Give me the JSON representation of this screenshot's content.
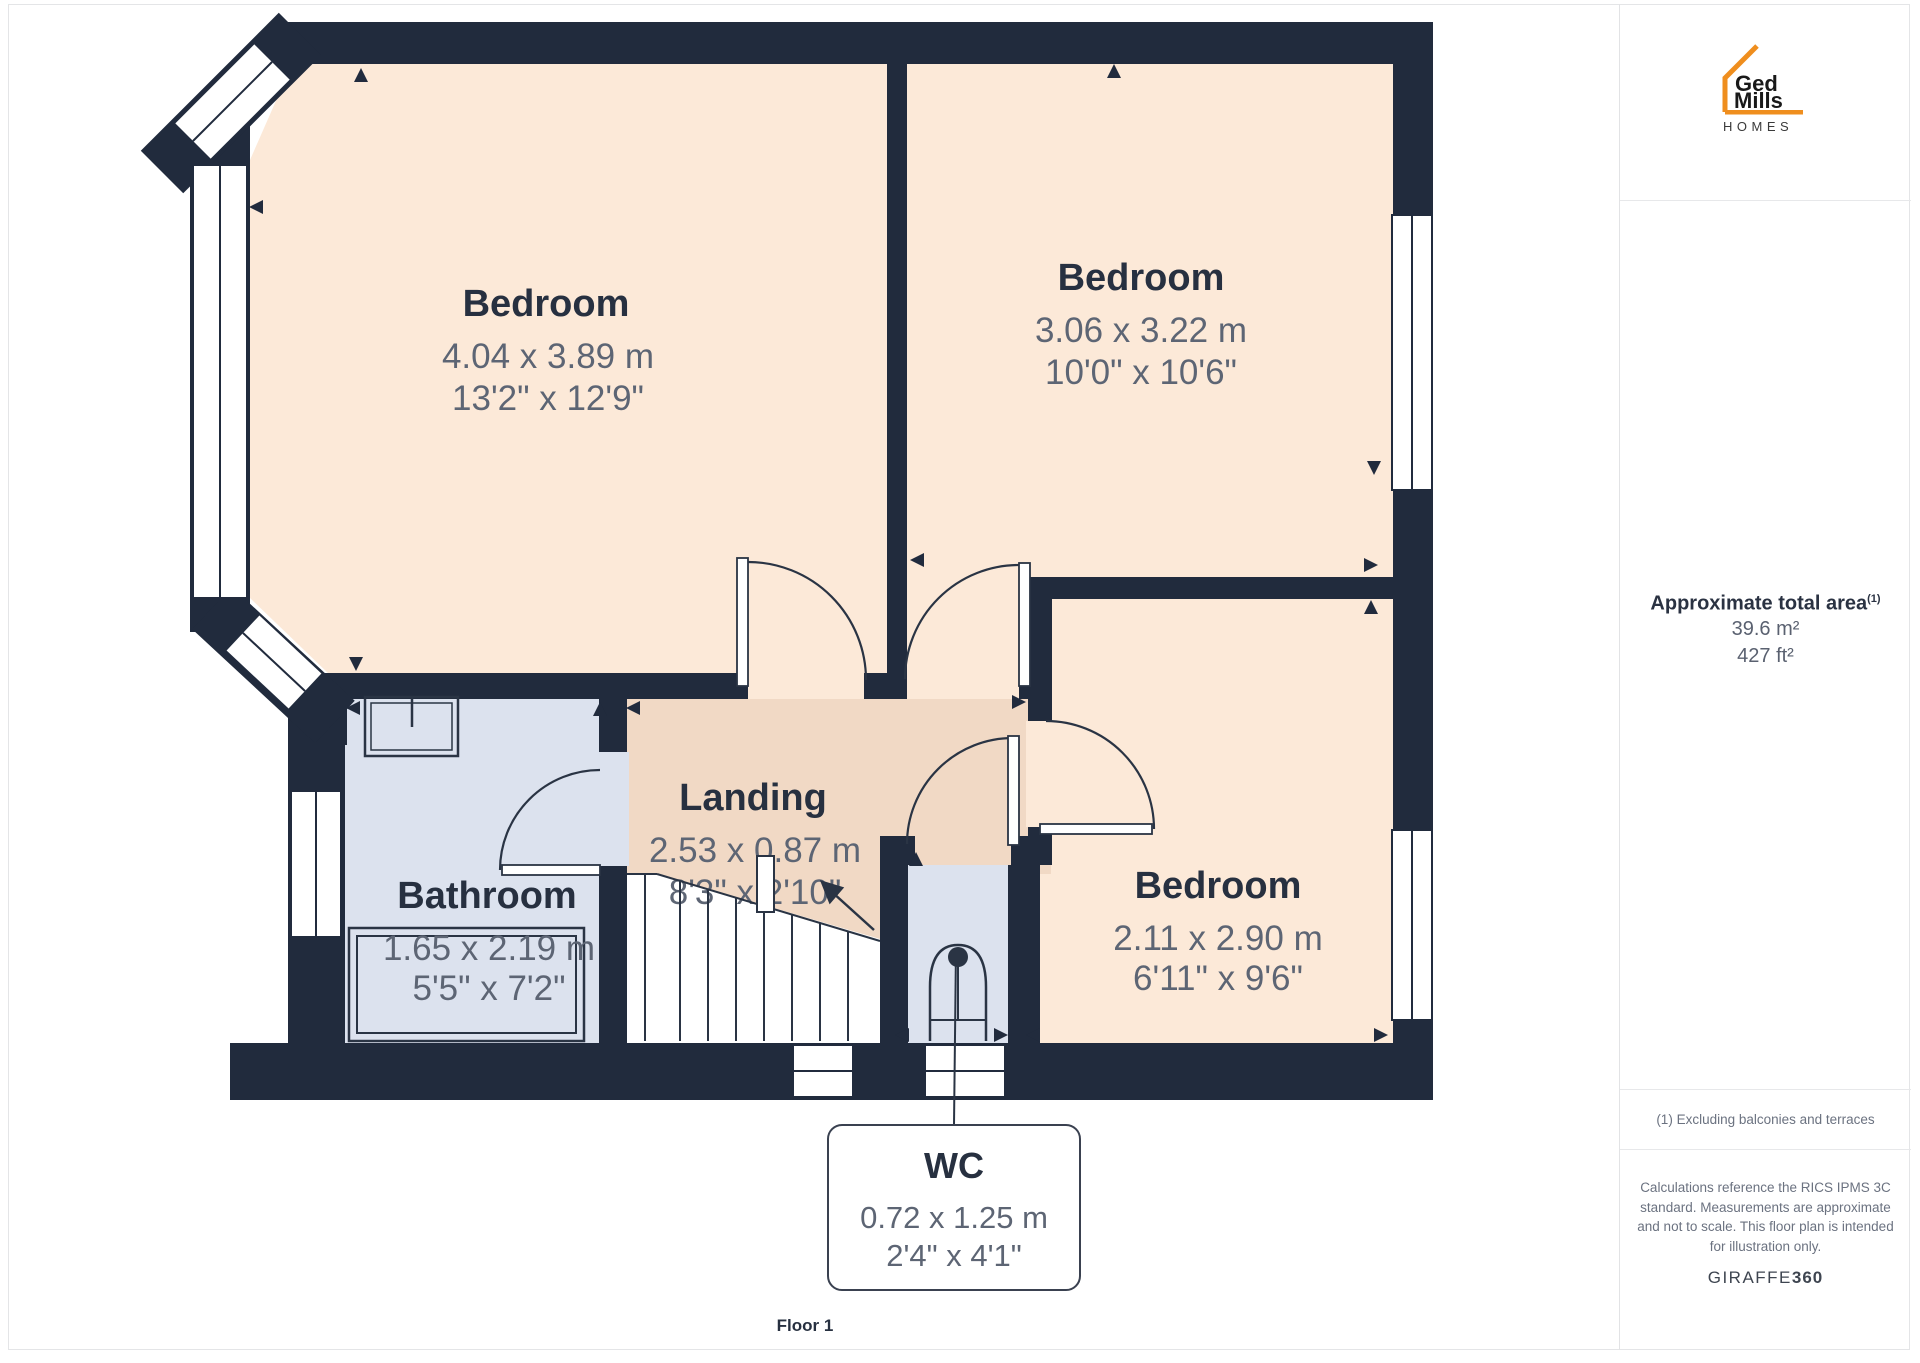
{
  "page": {
    "floor_label": "Floor 1"
  },
  "sidebar": {
    "logo": {
      "line1": "Ged",
      "line2": "Mills",
      "line3": "HOMES"
    },
    "area": {
      "title": "Approximate total area",
      "superscript": "(1)",
      "metric": "39.6 m²",
      "imperial": "427 ft²"
    },
    "footnote": "(1) Excluding balconies and terraces",
    "disclaimer": "Calculations reference the RICS IPMS 3C standard. Measurements are approximate and not to scale. This floor plan is intended for illustration only.",
    "provider": {
      "name": "GIRAFFE",
      "suffix": "360"
    }
  },
  "rooms": [
    {
      "id": "bedroom-1",
      "name": "Bedroom",
      "metric": "4.04 x 3.89 m",
      "imperial": "13'2\" x 12'9\""
    },
    {
      "id": "bedroom-2",
      "name": "Bedroom",
      "metric": "3.06 x 3.22 m",
      "imperial": "10'0\" x 10'6\""
    },
    {
      "id": "bedroom-3",
      "name": "Bedroom",
      "metric": "2.11 x 2.90 m",
      "imperial": "6'11\" x 9'6\""
    },
    {
      "id": "bathroom",
      "name": "Bathroom",
      "metric": "1.65 x 2.19 m",
      "imperial": "5'5\" x 7'2\""
    },
    {
      "id": "landing",
      "name": "Landing",
      "metric": "2.53 x 0.87 m",
      "imperial": "8'3\" x 2'10\""
    },
    {
      "id": "wc",
      "name": "WC",
      "metric": "0.72 x 1.25 m",
      "imperial": "2'4\" x 4'1\""
    }
  ],
  "colors": {
    "wall": "#212b3d",
    "bedroom_fill": "#fce9d8",
    "landing_fill": "#f1d9c5",
    "wet_room_fill": "#dce2ee",
    "brand_orange": "#EF8E1E",
    "label_title": "#273040",
    "label_dim": "#5d6574"
  }
}
